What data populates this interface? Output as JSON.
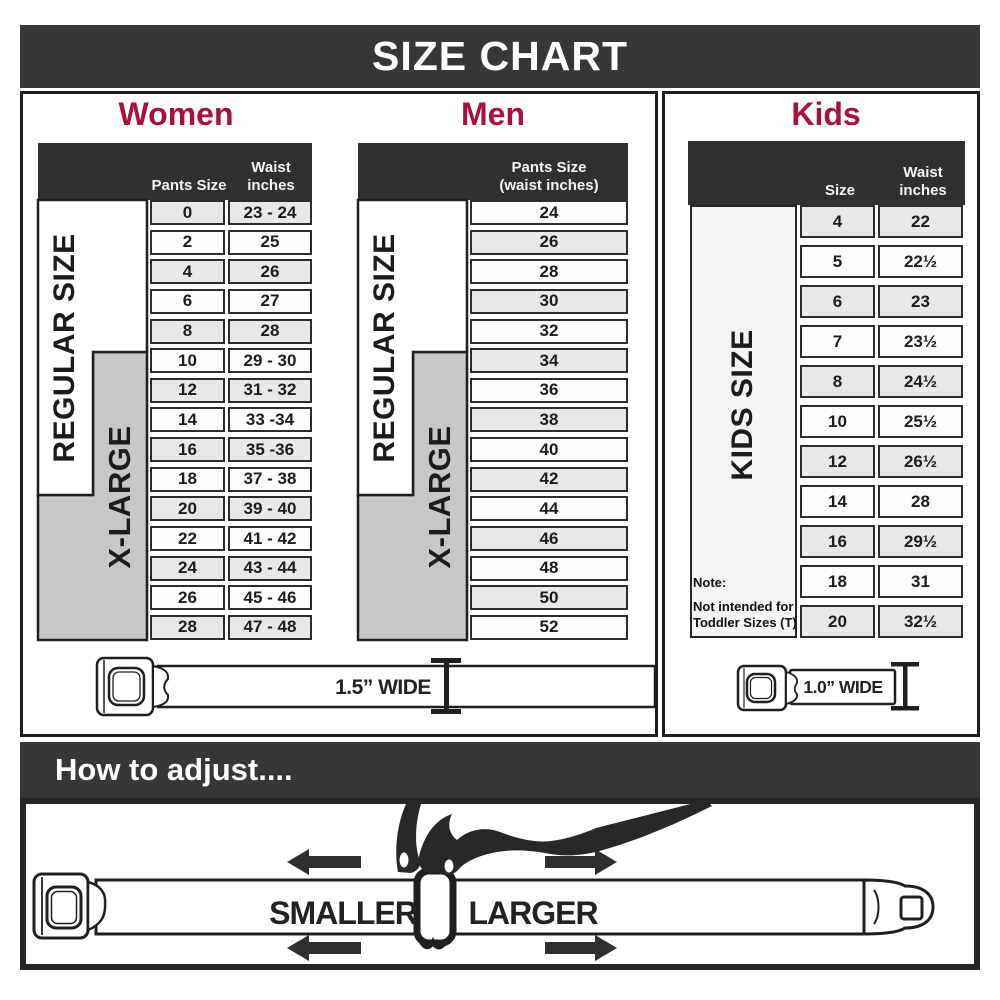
{
  "title": "SIZE CHART",
  "colors": {
    "banner_bg": "#373737",
    "header_bg": "#303030",
    "accent_red": "#a8113a",
    "xlarge_gray": "#c7c7c7",
    "row_alt": "#e8e8e8",
    "line_art": "#1f1f1f"
  },
  "sections": {
    "women": {
      "heading": "Women",
      "col1": "Pants Size",
      "col2a": "Waist",
      "col2b": "inches",
      "regular_label": "REGULAR SIZE",
      "xlarge_label": "X-LARGE",
      "rows": [
        {
          "size": "0",
          "waist": "23 - 24"
        },
        {
          "size": "2",
          "waist": "25"
        },
        {
          "size": "4",
          "waist": "26"
        },
        {
          "size": "6",
          "waist": "27"
        },
        {
          "size": "8",
          "waist": "28"
        },
        {
          "size": "10",
          "waist": "29 - 30"
        },
        {
          "size": "12",
          "waist": "31 - 32"
        },
        {
          "size": "14",
          "waist": "33 -34"
        },
        {
          "size": "16",
          "waist": "35 -36"
        },
        {
          "size": "18",
          "waist": "37 - 38"
        },
        {
          "size": "20",
          "waist": "39 - 40"
        },
        {
          "size": "22",
          "waist": "41 - 42"
        },
        {
          "size": "24",
          "waist": "43 - 44"
        },
        {
          "size": "26",
          "waist": "45 - 46"
        },
        {
          "size": "28",
          "waist": "47 - 48"
        }
      ]
    },
    "men": {
      "heading": "Men",
      "col1a": "Pants Size",
      "col1b": "(waist inches)",
      "regular_label": "REGULAR SIZE",
      "xlarge_label": "X-LARGE",
      "rows": [
        "24",
        "26",
        "28",
        "30",
        "32",
        "34",
        "36",
        "38",
        "40",
        "42",
        "44",
        "46",
        "48",
        "50",
        "52"
      ]
    },
    "kids": {
      "heading": "Kids",
      "col1": "Size",
      "col2a": "Waist",
      "col2b": "inches",
      "side_label": "KIDS SIZE",
      "note_lines": [
        "Note:",
        "Not intended for",
        "Toddler Sizes (T)"
      ],
      "rows": [
        {
          "size": "4",
          "waist": "22"
        },
        {
          "size": "5",
          "waist": "22½"
        },
        {
          "size": "6",
          "waist": "23"
        },
        {
          "size": "7",
          "waist": "23½"
        },
        {
          "size": "8",
          "waist": "24½"
        },
        {
          "size": "10",
          "waist": "25½"
        },
        {
          "size": "12",
          "waist": "26½"
        },
        {
          "size": "14",
          "waist": "28"
        },
        {
          "size": "16",
          "waist": "29½"
        },
        {
          "size": "18",
          "waist": "31"
        },
        {
          "size": "20",
          "waist": "32½"
        }
      ]
    }
  },
  "belts": {
    "adult_caption": "1.5” WIDE",
    "kids_caption": "1.0” WIDE"
  },
  "adjust": {
    "heading": "How to adjust....",
    "smaller": "SMALLER",
    "larger": "LARGER"
  }
}
